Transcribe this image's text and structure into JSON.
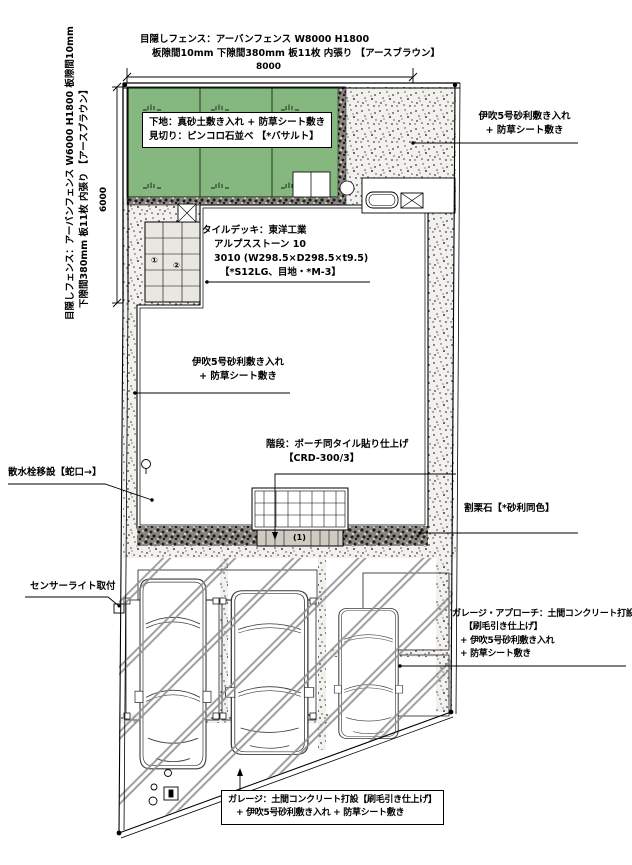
{
  "drawing_type": "外構計画図（平面図）",
  "dimensions": {
    "top_width": "8000",
    "left_height": "6000"
  },
  "labels": {
    "fence_top": {
      "line1": "目隠しフェンス：アーバンフェンス W8000 H1800",
      "line2": "板隙間10mm 下隙間380mm 板11枚 内張り 【アースブラウン】"
    },
    "fence_left": {
      "line1": "目隠しフェンス：アーバンフェンス W6000 H1800 板隙間10mm",
      "line2": "下隙間380mm 板11枚 内張り 【アースブラウン】"
    },
    "ground_box": {
      "line1": "下地：真砂土敷き入れ + 防草シート敷き",
      "line2": "見切り：ピンコロ石並べ 【*バサルト】"
    },
    "gravel_right": {
      "line1": "伊吹5号砂利敷き入れ",
      "line2": "+ 防草シート敷き"
    },
    "tile_deck": {
      "line1": "タイルデッキ：東洋工業",
      "line2": "アルプスストーン 10",
      "line3": "3010 (W298.5×D298.5×t9.5)",
      "line4": "【*S12LG、目地・*M-3】"
    },
    "gravel_mid": {
      "line1": "伊吹5号砂利敷き入れ",
      "line2": "+ 防草シート敷き"
    },
    "stairs": {
      "line1": "階段：ポーチ同タイル貼り仕上げ",
      "line2": "【CRD-300/3】"
    },
    "faucet": {
      "line1": "散水栓移設【蛇口→】"
    },
    "rubble": {
      "line1": "割栗石【*砂利同色】"
    },
    "sensor": {
      "line1": "センサーライト取付"
    },
    "approach": {
      "line1": "ガレージ・アプローチ：土間コンクリート打設",
      "line2": "【刷毛引き仕上げ】",
      "line3": "+ 伊吹5号砂利敷き入れ",
      "line4": "+ 防草シート敷き"
    },
    "garage_box": {
      "line1": "ガレージ：土間コンクリート打設【刷毛引き仕上げ】",
      "line2": "+ 伊吹5号砂利敷き入れ + 防草シート敷き"
    }
  },
  "markers": {
    "step_count": "(1)",
    "deck_tile_1": "①",
    "deck_tile_2": "②"
  },
  "colors": {
    "grass": "#84b87e",
    "gravel_bg": "#f2f1ed",
    "dark_stone": "#8a8781",
    "hatch_line": "#8f8f8f"
  }
}
